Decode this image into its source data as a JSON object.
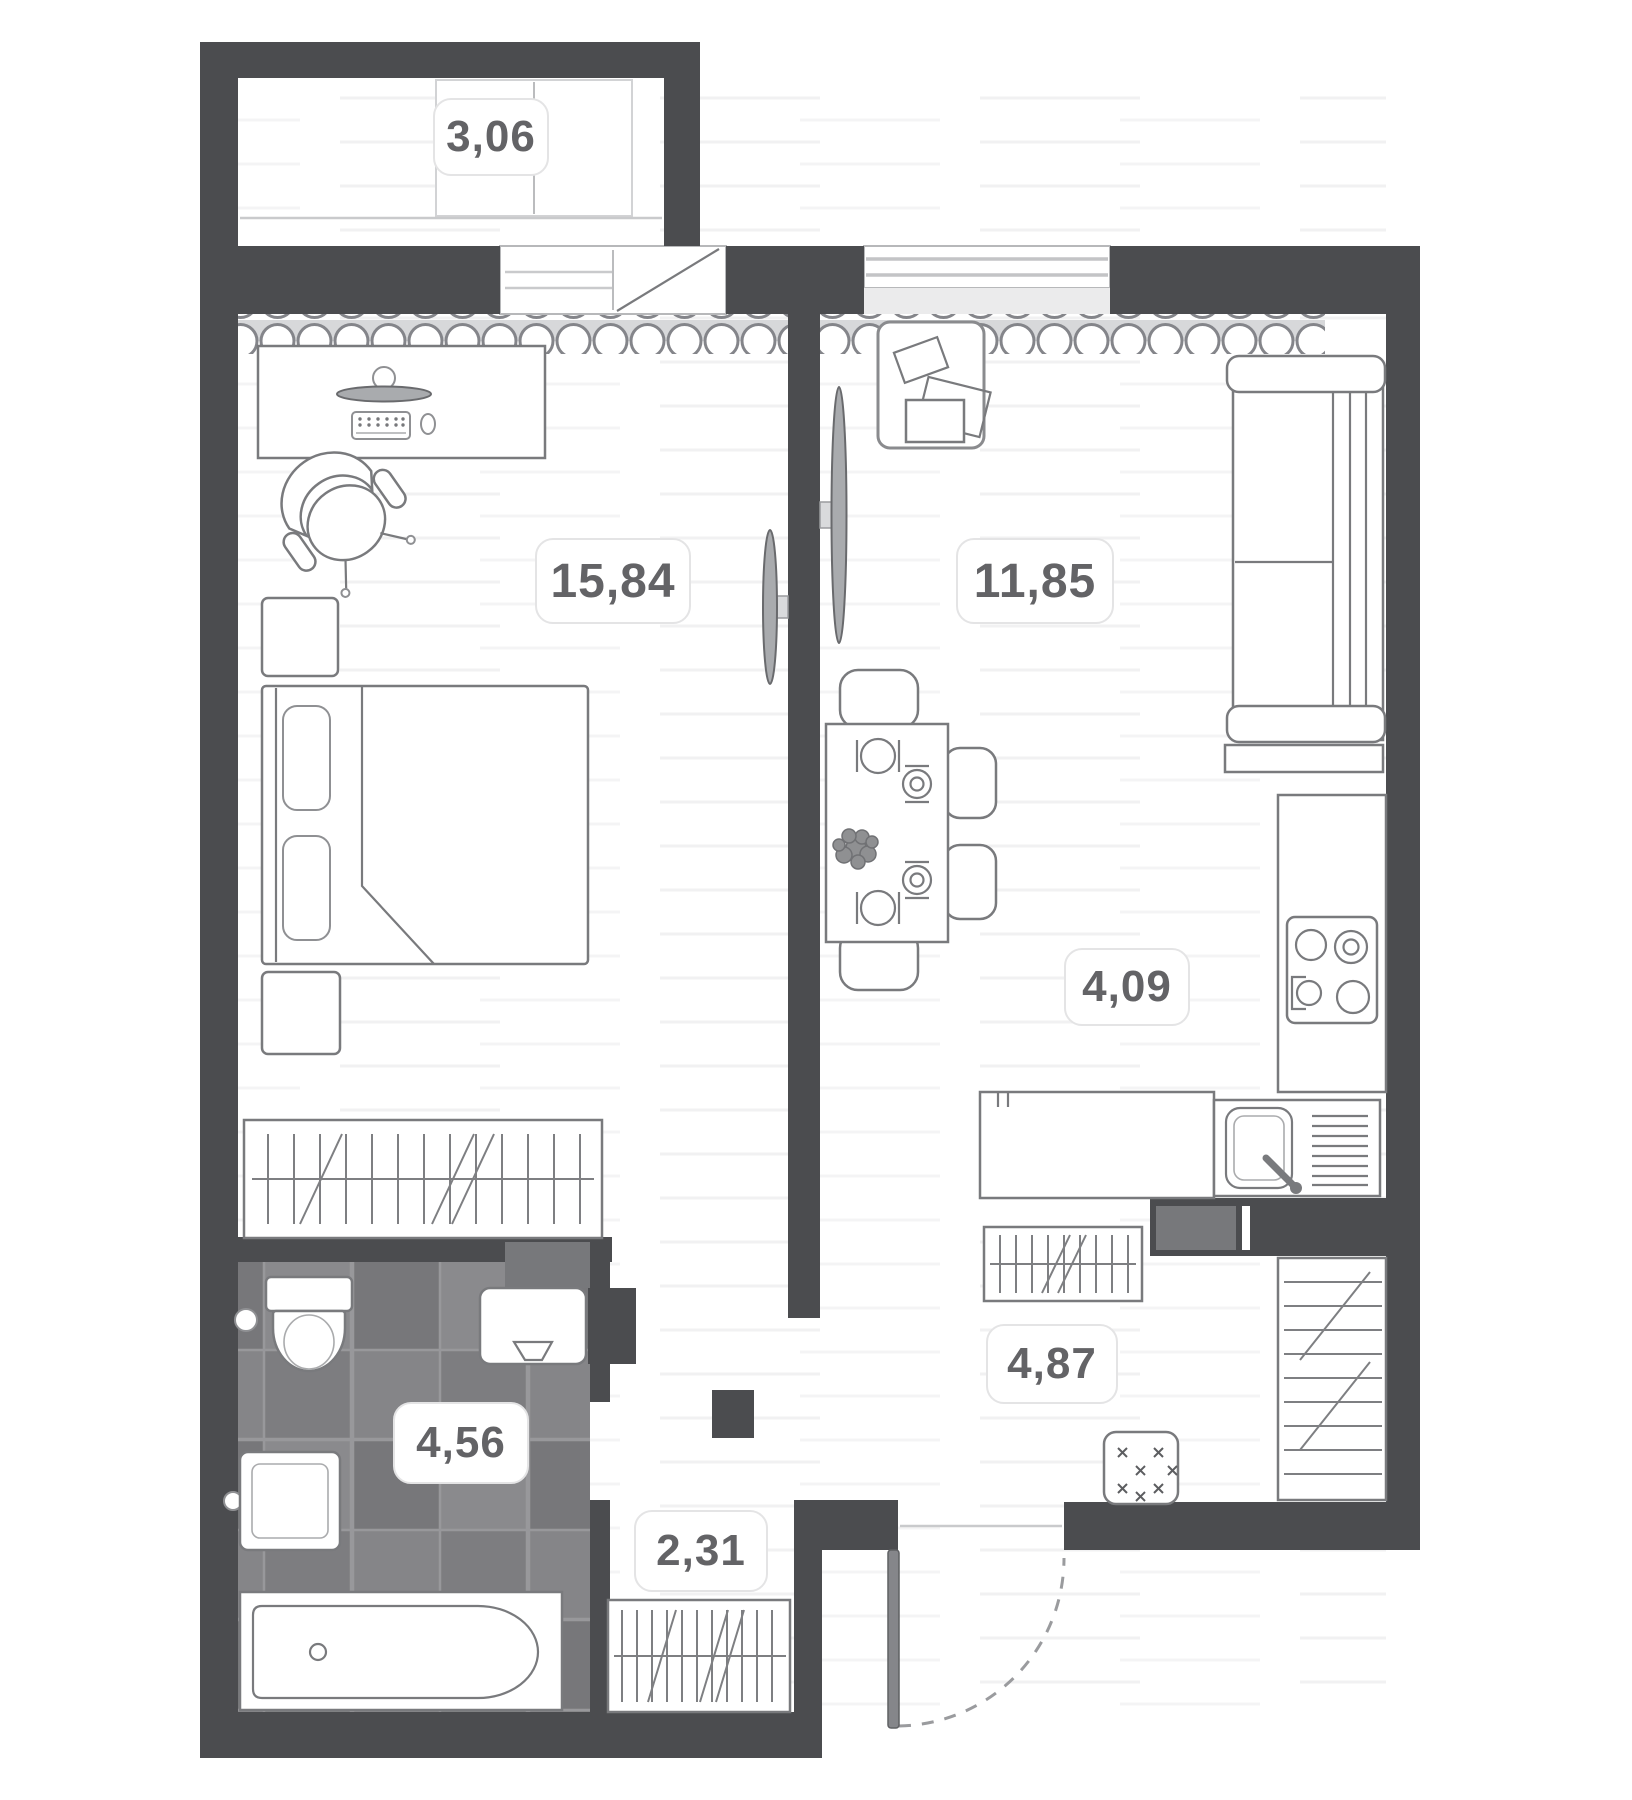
{
  "plan_type": "apartment-floor-plan",
  "rooms": [
    {
      "id": "balcony",
      "label": "3,06"
    },
    {
      "id": "bedroom",
      "label": "15,84"
    },
    {
      "id": "living",
      "label": "11,85"
    },
    {
      "id": "kitchen",
      "label": "4,09"
    },
    {
      "id": "hallway",
      "label": "4,87"
    },
    {
      "id": "bathroom",
      "label": "4,56"
    },
    {
      "id": "corridor",
      "label": "2,31"
    }
  ],
  "colors": {
    "wall": "#4b4c4f",
    "furniture_line": "#797a7d",
    "tile_floor": "#818184",
    "radiator_band": "#d7d8da",
    "label_text": "#636366",
    "label_border": "#e4e4e5"
  },
  "icons": [
    "bed",
    "pillow",
    "wardrobe-hatch",
    "desk",
    "monitor",
    "keyboard",
    "mouse",
    "office-chair",
    "nightstand",
    "tv",
    "sofa",
    "dining-table",
    "dining-chair",
    "plate",
    "plant",
    "picture-frame",
    "stove-burners",
    "kitchen-sink",
    "toilet",
    "washbasin",
    "bathtub",
    "washing-machine",
    "doormat",
    "pouf",
    "entrance-door-swing",
    "window",
    "radiator-scallop"
  ]
}
